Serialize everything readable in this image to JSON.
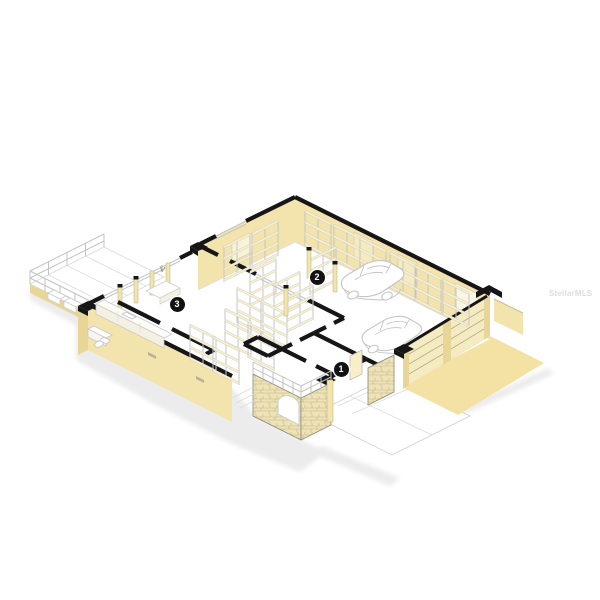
{
  "scene": {
    "description": "Isometric cutaway 3D floor plan of a single-story home with large garage workshop, kitchen wing, wood deck, stone entry porch and driveway",
    "background": "#ffffff"
  },
  "watermark": {
    "text": "StellarMLS"
  },
  "markers": [
    {
      "label": "1",
      "area": "front entry vestibule"
    },
    {
      "label": "2",
      "area": "garage workshop with two cars"
    },
    {
      "label": "3",
      "area": "kitchen"
    }
  ],
  "features": [
    "car-icon (two parked cars in garage)",
    "shelving-rack-icon (storage racks along walls and freestanding)",
    "kitchen-counter with sink",
    "bathroom-fixtures",
    "deck with railing",
    "stone entry porch with arch and railing",
    "garage doors with slats",
    "tan driveway and white parking pad"
  ],
  "colors": {
    "cream": "#F2E4AC",
    "cream_light": "#F8EFCA",
    "cream_dark": "#E8D598",
    "door": "#F5EBC0",
    "tan": "#F4E1A4",
    "ink": "#161616",
    "line": "#C3C3C3",
    "softline": "#DCDCDC",
    "shadow": "#ECECEC",
    "stone": "#EFE3B6",
    "stoneline": "#BFB493",
    "marker_bg": "#121212",
    "marker_fg": "#FFFFFF",
    "watermark": "#D7D7D7"
  }
}
